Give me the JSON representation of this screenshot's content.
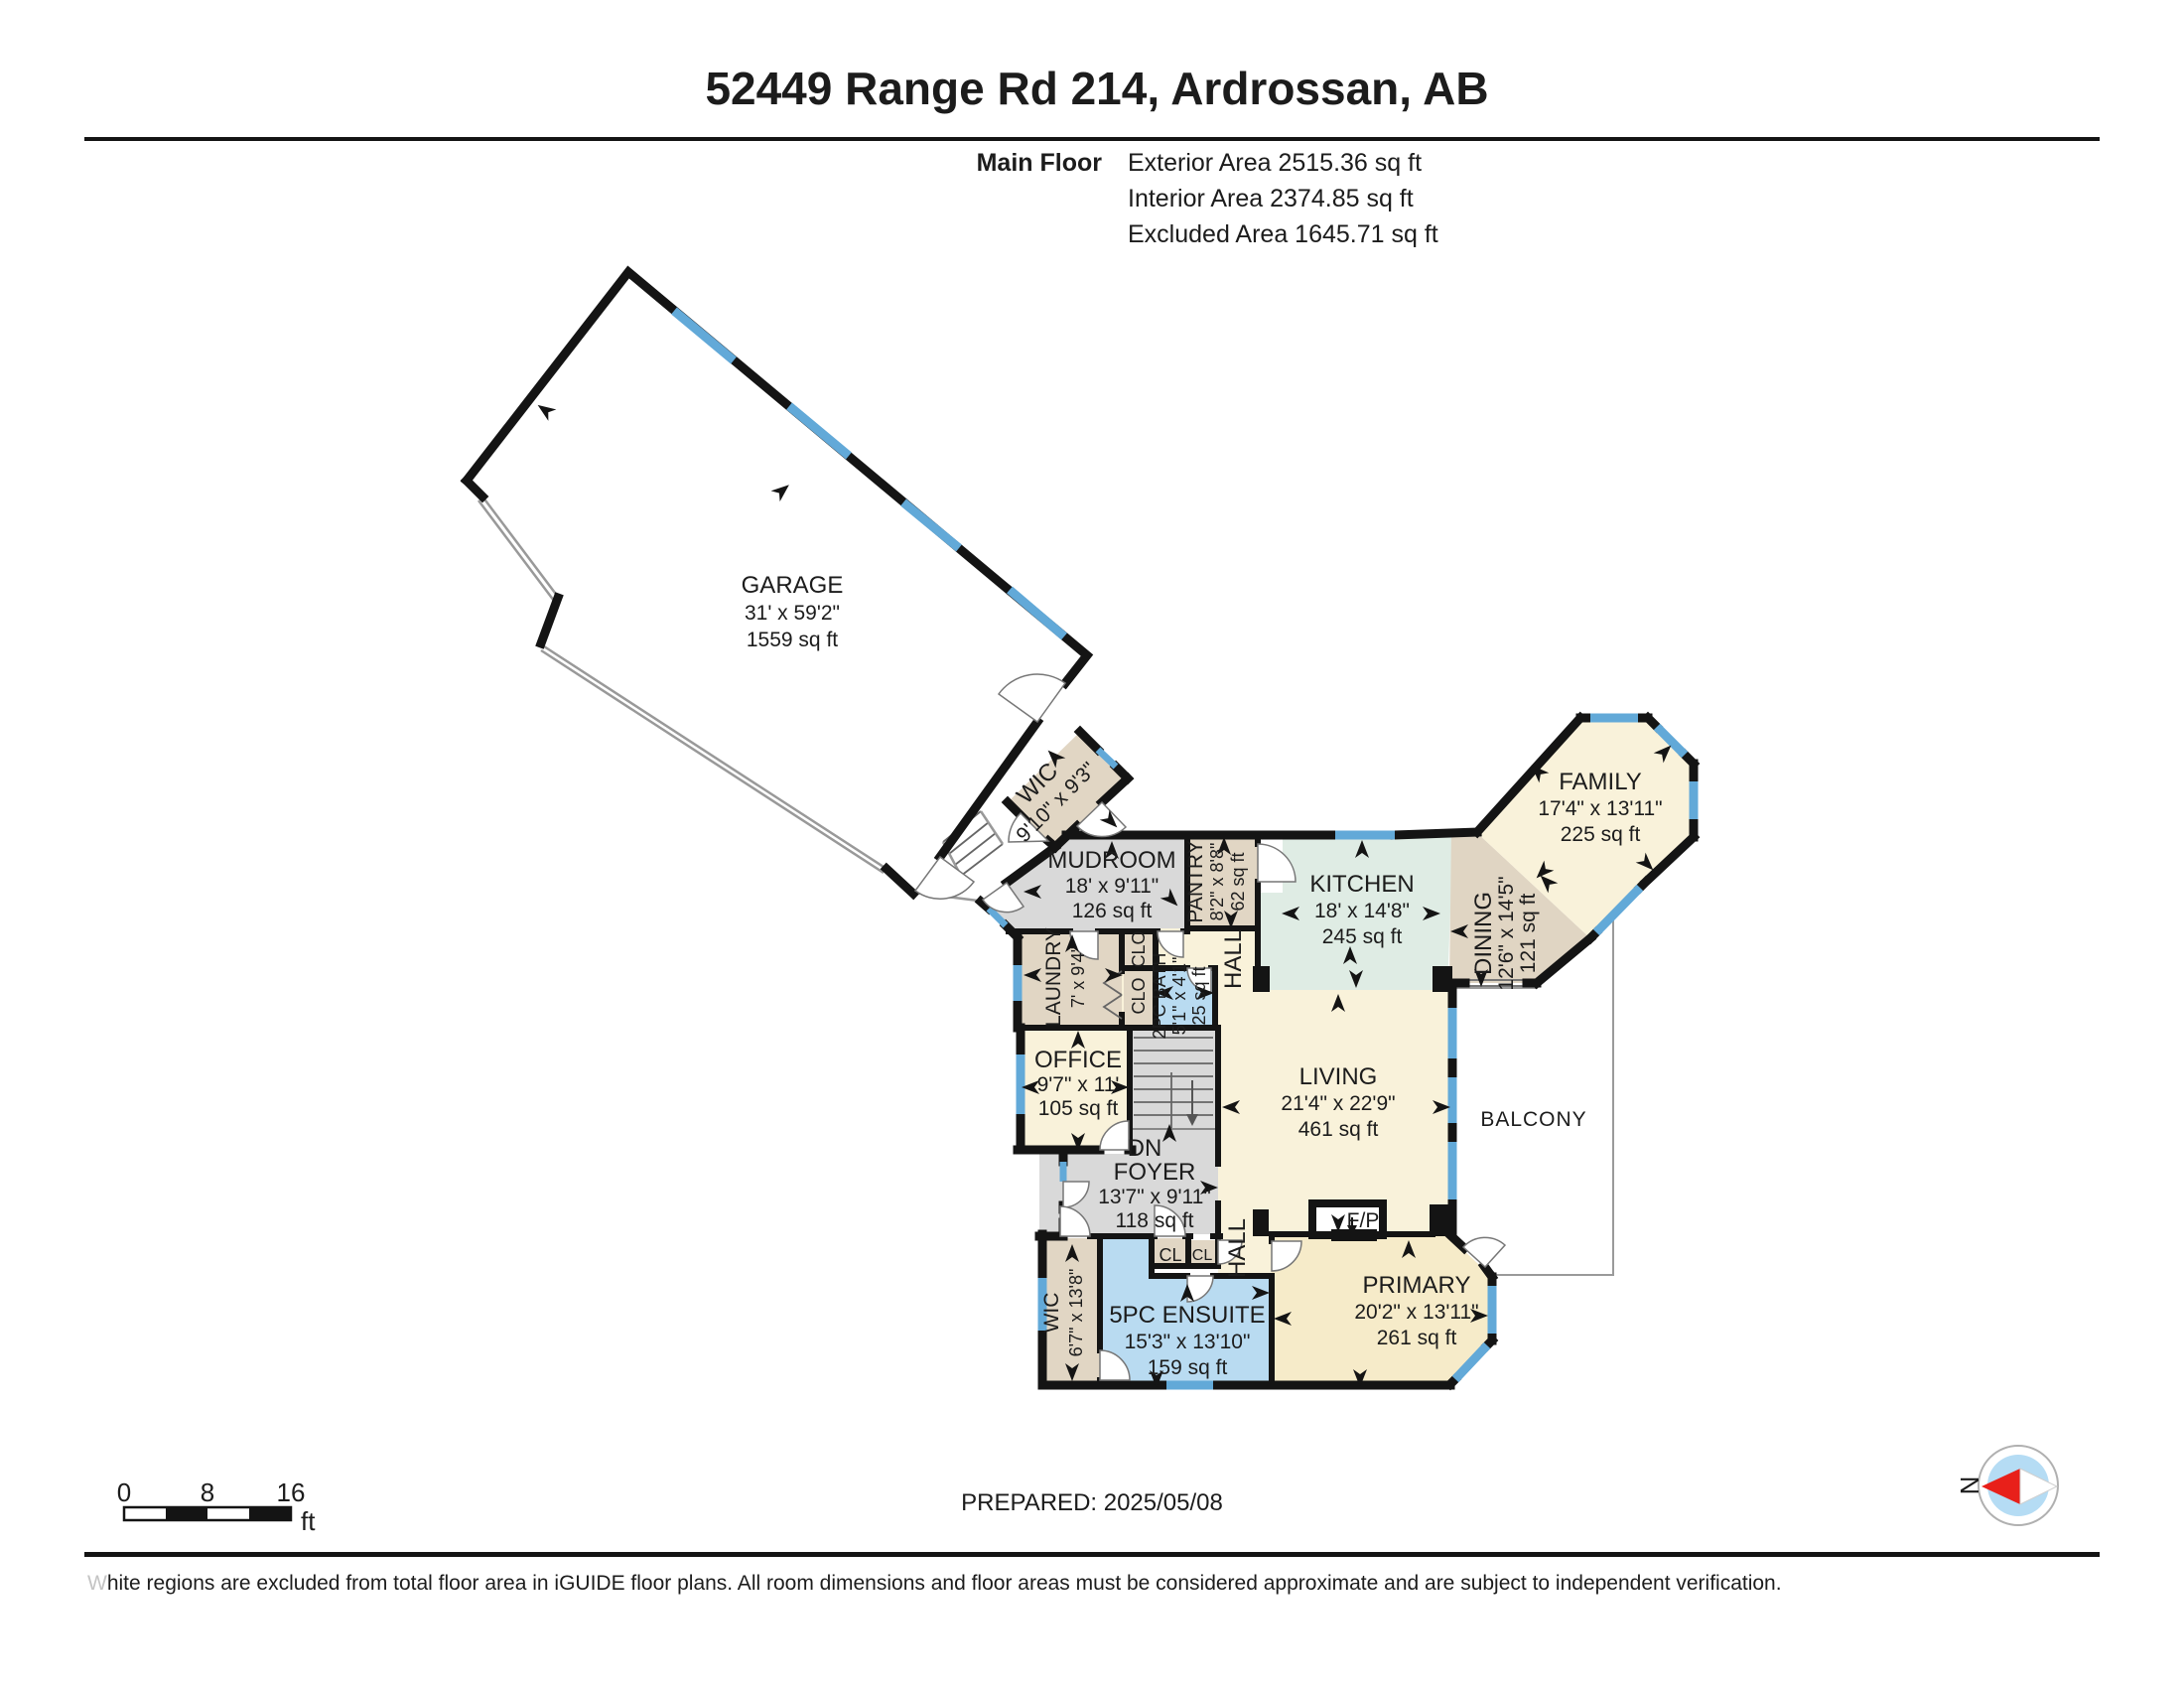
{
  "header": {
    "title": "52449 Range Rd 214, Ardrossan, AB",
    "floor_label": "Main Floor",
    "exterior_area": "Exterior Area 2515.36 sq ft",
    "interior_area": "Interior Area 2374.85 sq ft",
    "excluded_area": "Excluded Area 1645.71 sq ft"
  },
  "rooms": {
    "garage": {
      "name": "GARAGE",
      "dims": "31' x 59'2\"",
      "area": "1559 sq ft"
    },
    "wic_upper": {
      "name": "WIC",
      "dims": "9'10\" x 9'3\""
    },
    "mudroom": {
      "name": "MUDROOM",
      "dims": "18' x 9'11\"",
      "area": "126 sq ft"
    },
    "pantry": {
      "name": "PANTRY",
      "dims": "8'2\" x 8'8\"",
      "area": "62 sq ft"
    },
    "kitchen": {
      "name": "KITCHEN",
      "dims": "18' x 14'8\"",
      "area": "245 sq ft"
    },
    "family": {
      "name": "FAMILY",
      "dims": "17'4\" x 13'11\"",
      "area": "225 sq ft"
    },
    "dining": {
      "name": "DINING",
      "dims": "12'6\" x 14'5\"",
      "area": "121 sq ft"
    },
    "laundry": {
      "name": "LAUNDRY",
      "dims": "7' x 9'4\""
    },
    "bath_2pc": {
      "name": "2PC BATH",
      "dims": "5'1\" x 4'1\"",
      "area": "25 sq ft"
    },
    "office": {
      "name": "OFFICE",
      "dims": "9'7\" x 11'",
      "area": "105 sq ft"
    },
    "foyer": {
      "name": "FOYER",
      "dims": "13'7\" x 9'11\"",
      "area": "118 sq ft"
    },
    "living": {
      "name": "LIVING",
      "dims": "21'4\" x 22'9\"",
      "area": "461 sq ft"
    },
    "primary": {
      "name": "PRIMARY",
      "dims": "20'2\" x 13'11\"",
      "area": "261 sq ft"
    },
    "ensuite": {
      "name": "5PC ENSUITE",
      "dims": "15'3\" x 13'10\"",
      "area": "159 sq ft"
    },
    "wic_lower": {
      "name": "WIC",
      "dims": "6'7\" x 13'8\""
    },
    "balcony": {
      "name": "BALCONY"
    }
  },
  "labels": {
    "hall_upper": "HALL",
    "hall_lower": "HALL",
    "closet_upper": "CLO",
    "closet_lower": "CLO",
    "closet_1": "CL",
    "closet_2": "CL",
    "fireplace": "F/P",
    "stairs_down": "DN",
    "compass_north": "N"
  },
  "scale_bar": {
    "tick_0": "0",
    "tick_8": "8",
    "tick_16": "16",
    "unit": "ft"
  },
  "footer": {
    "prepared": "PREPARED: 2025/05/08",
    "disclaimer_first_letter": "W",
    "disclaimer_rest": "hite regions are excluded from total floor area in iGUIDE floor plans. All room dimensions and floor areas must be considered approximate and are subject to independent verification."
  },
  "colors": {
    "wall": "#141414",
    "window": "#62a9d8",
    "room_cream": "#f9f2da",
    "room_cream_warm": "#f6ebc9",
    "room_tan": "#e1d6c4",
    "room_gray": "#d9d9d9",
    "room_blue": "#b9dbf1",
    "room_kitchen": "#dfece4",
    "compass_red": "#e8201a",
    "compass_blue": "#b5dcf4"
  }
}
